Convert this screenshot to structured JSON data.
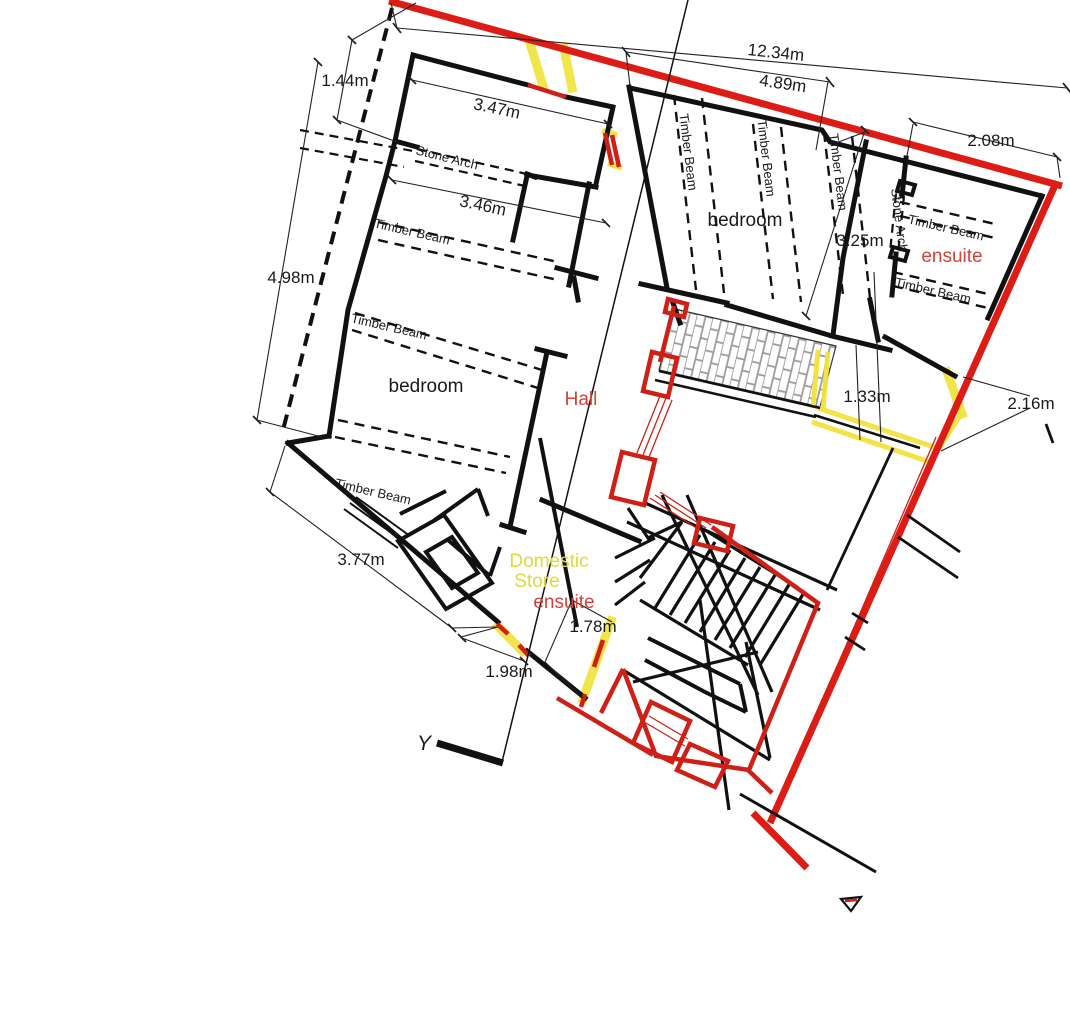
{
  "labels": {
    "dimensions": {
      "d1234": "12.34m",
      "d489": "4.89m",
      "d144": "1.44m",
      "d347": "3.47m",
      "d346": "3.46m",
      "d498": "4.98m",
      "d208": "2.08m",
      "d325": "3.25m",
      "d133": "1.33m",
      "d216": "2.16m",
      "d377": "3.77m",
      "d178": "1.78m",
      "d198": "1.98m"
    },
    "rooms": {
      "bedroom_left": "bedroom",
      "bedroom_right": "bedroom",
      "hall": "Hall",
      "ensuite_right": "ensuite",
      "ensuite_lower": "ensuite",
      "store_line1": "Domestic",
      "store_line2": "Store"
    },
    "annotations": {
      "stone_arch": "Stone Arch",
      "timber_beam": "Timber Beam",
      "section_marker": "Y"
    },
    "colors": {
      "boundary_red": "#dd1d15",
      "wall_black": "#111111",
      "highlight_yellow": "#f1e23c",
      "annotation_red": "#d24238",
      "hatch_gray": "#9a9a9a"
    }
  }
}
